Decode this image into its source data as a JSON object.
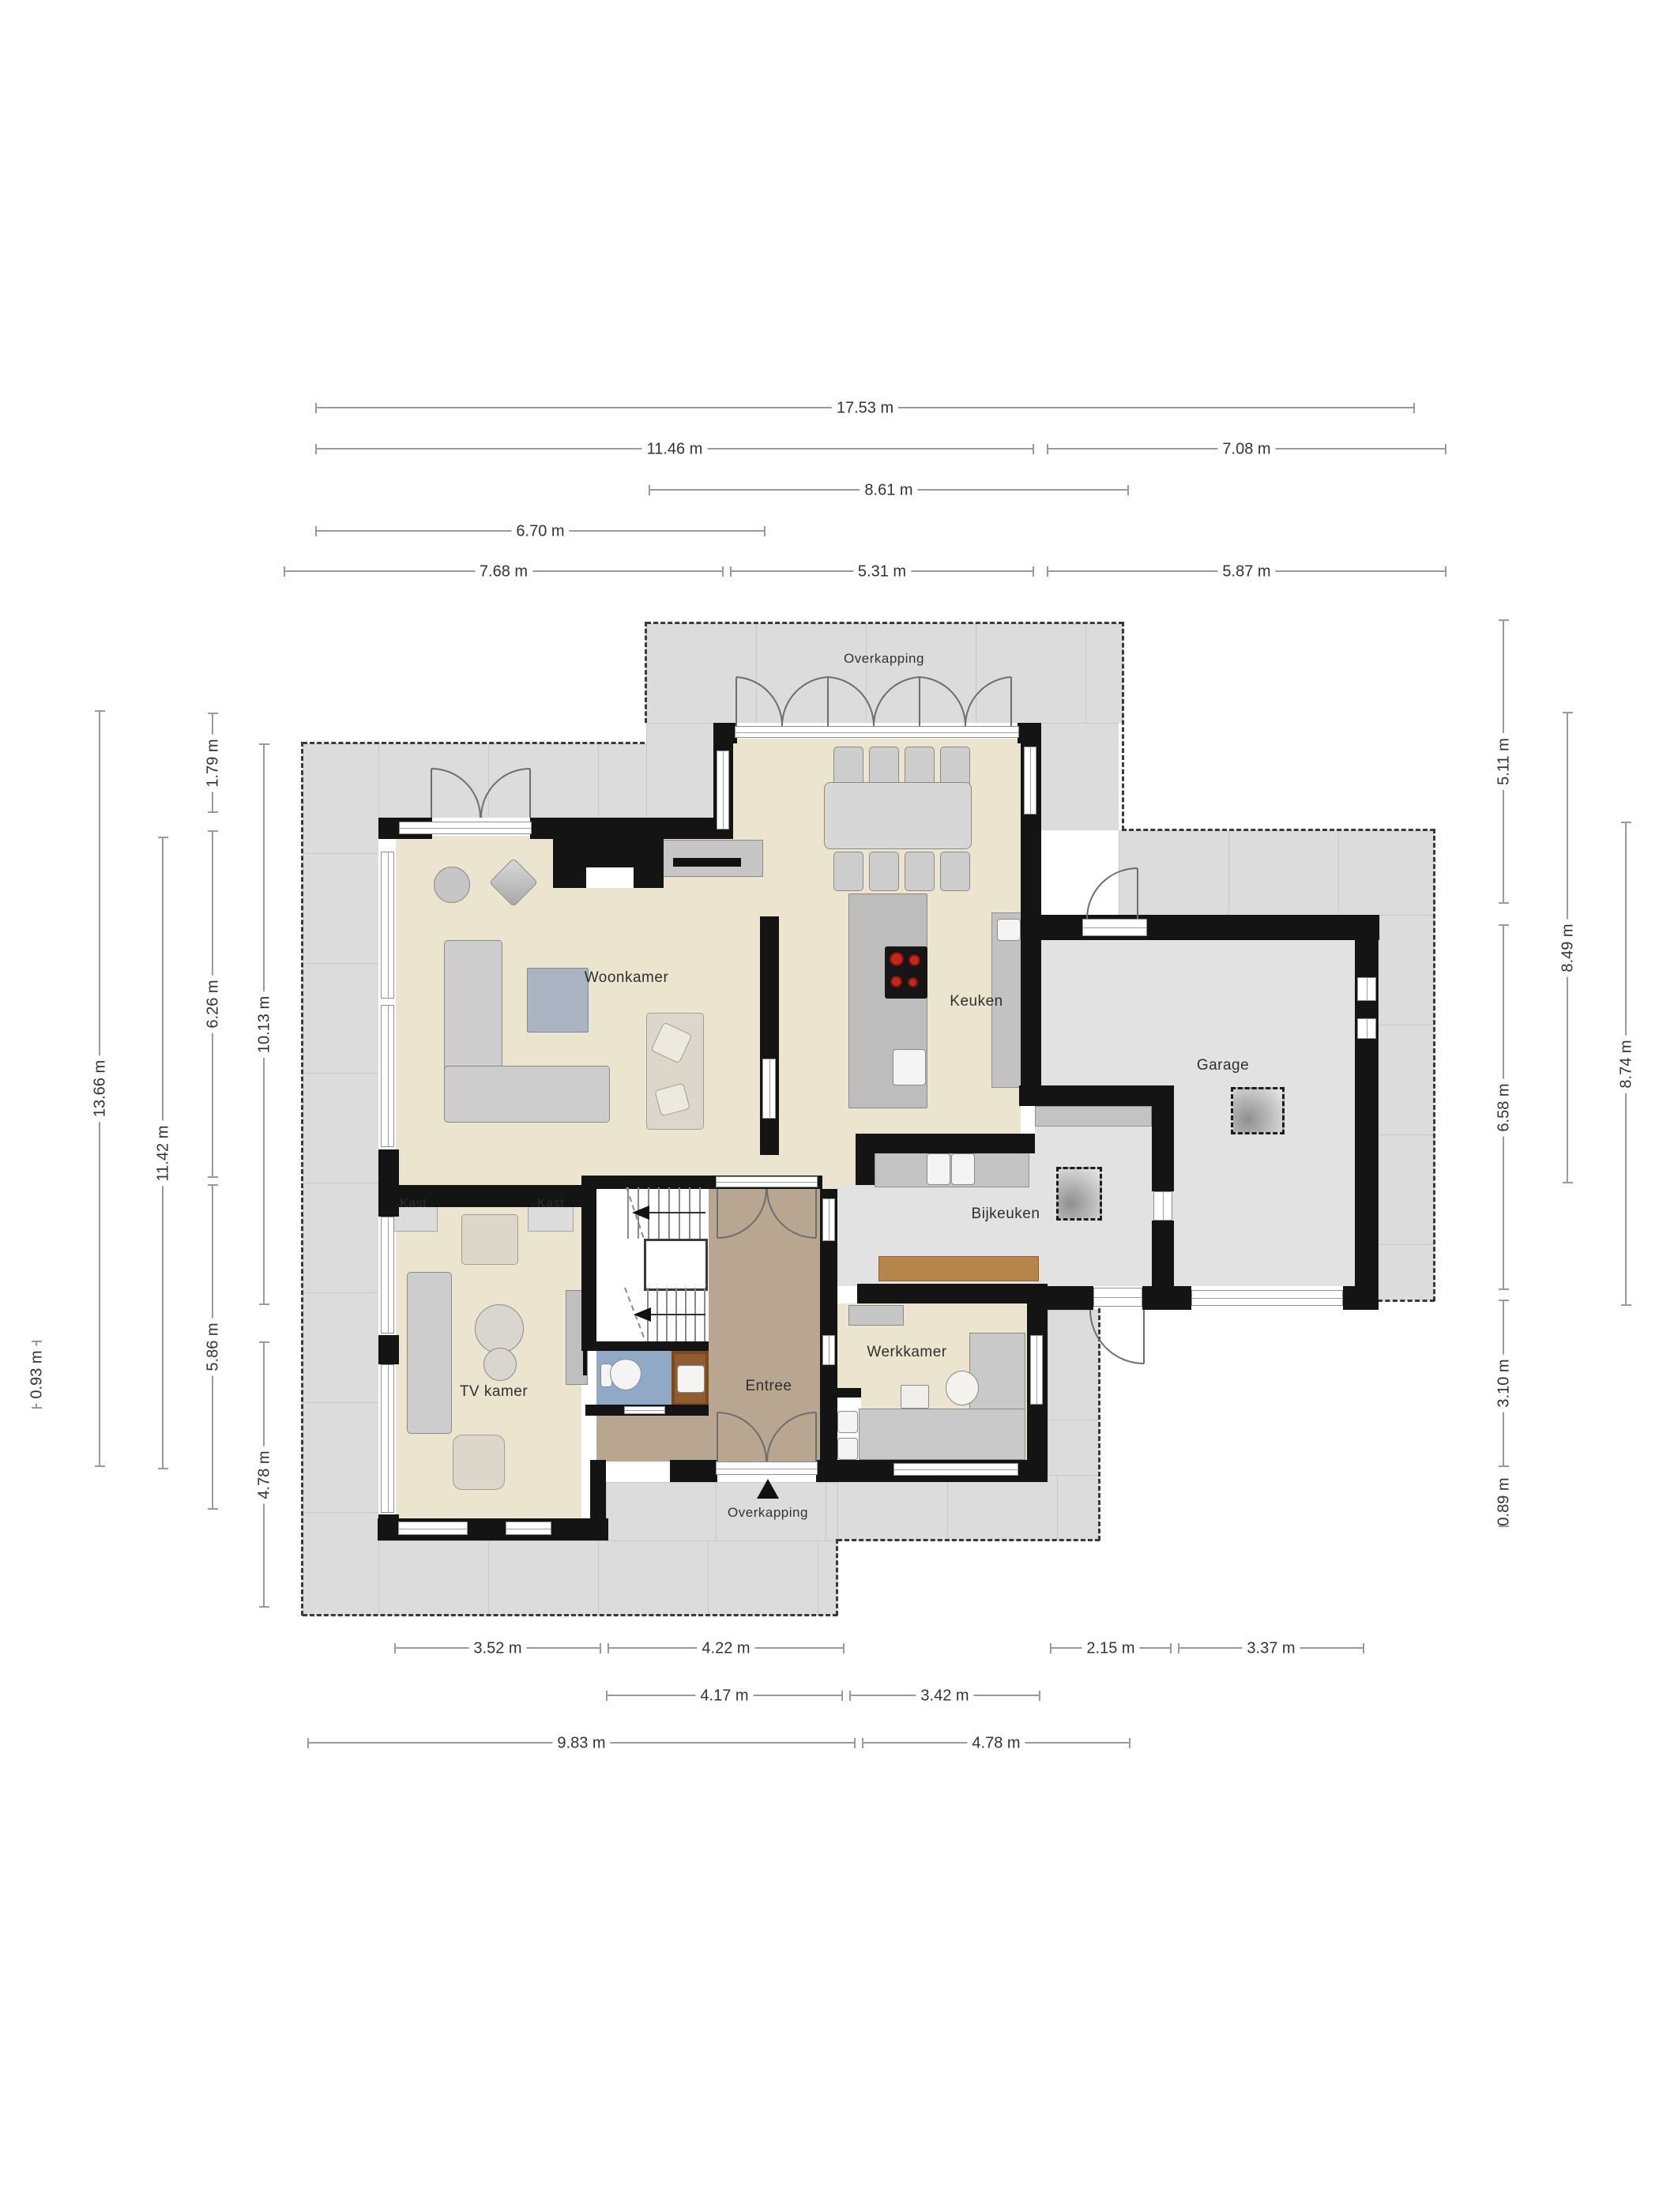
{
  "plan_title": "Begane grond floor plan",
  "rooms": {
    "woonkamer": "Woonkamer",
    "keuken": "Keuken",
    "garage": "Garage",
    "bijkeuken": "Bijkeuken",
    "werkkamer": "Werkkamer",
    "tvkamer": "TV kamer",
    "entree": "Entree",
    "kast": "Kast",
    "overkapping": "Overkapping"
  },
  "dimensions": {
    "top": [
      "17.53 m",
      "11.46 m",
      "7.08 m",
      "8.61 m",
      "6.70 m",
      "7.68 m",
      "5.31 m",
      "5.87 m"
    ],
    "left": [
      "13.66 m",
      "11.42 m",
      "1.79 m",
      "6.26 m",
      "5.86 m",
      "10.13 m",
      "4.78 m",
      "0.93 m"
    ],
    "right": [
      "5.11 m",
      "6.58 m",
      "3.10 m",
      "0.89 m",
      "8.49 m",
      "8.74 m"
    ],
    "bottom": [
      "3.52 m",
      "4.22 m",
      "2.15 m",
      "3.37 m",
      "4.17 m",
      "3.42 m",
      "9.83 m",
      "4.78 m"
    ]
  },
  "colors": {
    "wall": "#141414",
    "room_floor": "#ebe4cf",
    "terrace": "#dcdcdc",
    "utility_floor": "#e2e2e2",
    "entree_floor": "#b8a691",
    "toilet_floor": "#8fa9c6",
    "wood": "#7b4a21",
    "bench_wood": "#b5854a",
    "burner_red": "#c9251b",
    "dimension_line": "#9a9a9a"
  }
}
